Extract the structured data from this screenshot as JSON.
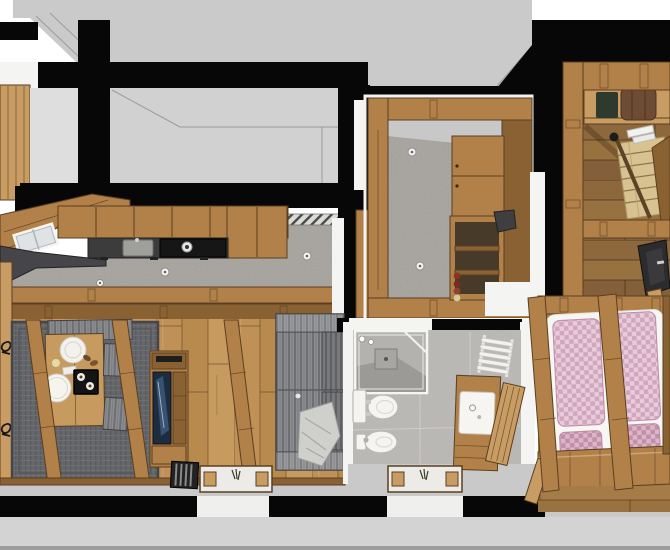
{
  "scene": {
    "kind": "3d-cutaway-floorplan-render",
    "rooms": [
      {
        "id": "kitchen",
        "floor": "speckled-stone",
        "items": [
          "wall-cabinets",
          "dark-countertop",
          "sink",
          "cooktop",
          "roof-skylight",
          "desk"
        ]
      },
      {
        "id": "pantry",
        "floor": "speckled-stone",
        "items": [
          "wall-cabinet",
          "open-shelves",
          "bottles"
        ]
      },
      {
        "id": "stair-hall",
        "floor": "dark-wood-planks",
        "items": [
          "sideboard",
          "seat-cushion",
          "staircase",
          "railing",
          "armchair"
        ]
      },
      {
        "id": "living-dining",
        "floor": "wood-planks",
        "items": [
          "rug",
          "dining-table",
          "plate",
          "bowl",
          "coffee-tray",
          "chairs",
          "bench",
          "tv-cabinet",
          "sofa",
          "blanket",
          "roof-rafters"
        ]
      },
      {
        "id": "bathroom",
        "floor": "gray-tile",
        "items": [
          "shower",
          "toilet",
          "bidet",
          "vanity-sink",
          "tall-cabinet",
          "towel-radiator"
        ]
      },
      {
        "id": "bedroom",
        "floor": "wood-planks",
        "items": [
          "double-bed",
          "pink-checked-mattresses",
          "pink-pillows",
          "footboard-bench",
          "roof-rafters"
        ]
      }
    ],
    "exterior": [
      "gray-roof-planes",
      "black-cut-walls",
      "facade-windows",
      "doormats",
      "floor-vent"
    ]
  },
  "palette": {
    "page-bg": "#ffffff",
    "ground": "#d3d3d3",
    "ground-dark": "#9d9d9d",
    "walkway": "#c9c9c9",
    "wall": "#070707",
    "roof": "#cacaca",
    "roof2": "#d1d1d1",
    "roof-line": "#9b9b9b",
    "white-wall": "#f4f4f3",
    "wood": "#b28049",
    "wood-dark": "#8a6133",
    "wood-light": "#c99c64",
    "wood-edge": "#5a3f20",
    "plank1": "#c09156",
    "plank2": "#b88a4d",
    "plank3": "#c79a5f",
    "plankd1": "#8d683c",
    "plankd2": "#97713f",
    "plankd3": "#83603a",
    "plankm1": "#a57c47",
    "plankm2": "#9a7240",
    "plankm3": "#ae8552",
    "stone": "#aeaba5",
    "tile": "#bcbbb7",
    "counter": "#3c3c3c",
    "cooktop": "#161616",
    "steel": "#9f9f9c",
    "fabric": "#8b8d90",
    "fabric-line": "#6d6f73",
    "fabric-dark": "#77797d",
    "fabric-dark-line": "#5e6064",
    "rug": "#65676b",
    "rug-line": "#595b5f",
    "rug-hi": "#6d6f73",
    "blanket": "#cfcfcb",
    "pink": "#e7cdda",
    "pink-check": "#d2a6bf",
    "pink-edge": "#bd8ba6",
    "pink2": "#dcb5c8",
    "pink2-check": "#c28fa9",
    "fixture": "#f5f4f0",
    "navy": "#1e2c40",
    "stairs": "#d8c292",
    "leather": "#6e4c34",
    "cushion-pad": "#2e3a2e",
    "chair-dark": "#2c2c2e"
  }
}
